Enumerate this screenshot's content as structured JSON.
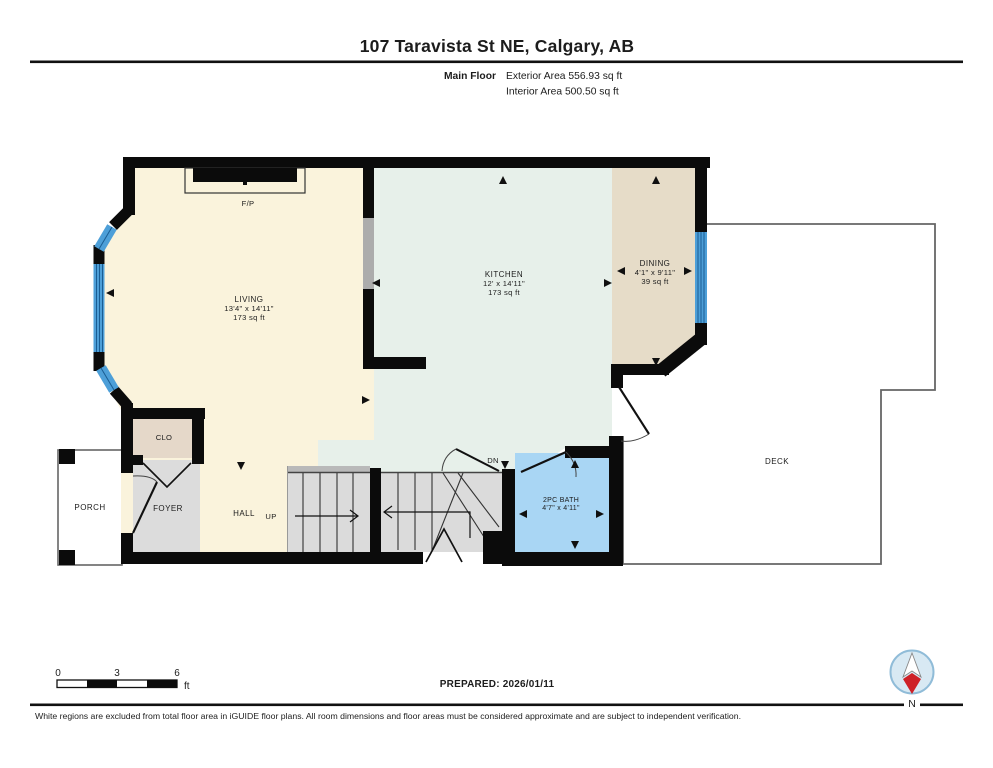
{
  "header": {
    "title": "107 Taravista St NE, Calgary, AB",
    "floor_label": "Main Floor",
    "exterior_area": "Exterior Area 556.93 sq ft",
    "interior_area": "Interior Area 500.50 sq ft"
  },
  "rooms": {
    "living": {
      "name": "LIVING",
      "dims": "13'4\" x 14'11\"",
      "area": "173 sq ft"
    },
    "kitchen": {
      "name": "KITCHEN",
      "dims": "12' x 14'11\"",
      "area": "173 sq ft"
    },
    "dining": {
      "name": "DINING",
      "dims": "4'1\" x 9'11\"",
      "area": "39 sq ft"
    },
    "bath": {
      "name": "2PC BATH",
      "dims": "4'7\" x 4'11\""
    },
    "closet": {
      "name": "CLO"
    },
    "foyer": {
      "name": "FOYER"
    },
    "hall": {
      "name": "HALL"
    },
    "porch": {
      "name": "PORCH"
    },
    "deck": {
      "name": "DECK"
    },
    "fireplace": {
      "name": "F/P"
    },
    "stairs": {
      "up": "UP",
      "down": "DN"
    }
  },
  "scale_bar": {
    "tick0": "0",
    "tick3": "3",
    "tick6": "6",
    "unit": "ft"
  },
  "prepared": "PREPARED: 2026/01/11",
  "compass": {
    "north_label": "N"
  },
  "footer": "White regions are excluded from total floor area in iGUIDE floor plans. All room dimensions and floor areas must be considered approximate and are subject to independent verification.",
  "colors": {
    "wall": "#0b0b0b",
    "living_fill": "#FAF3DC",
    "kitchen_fill": "#E7F0EA",
    "dining_fill": "#E6DCC8",
    "closet_fill": "#E5D8C9",
    "foyer_fill": "#DCDCDC",
    "stair_fill": "#DBDBDB",
    "bath_fill": "#A9D6F4",
    "window_blue": "#4D9FD8",
    "compass_red": "#CE2127"
  }
}
